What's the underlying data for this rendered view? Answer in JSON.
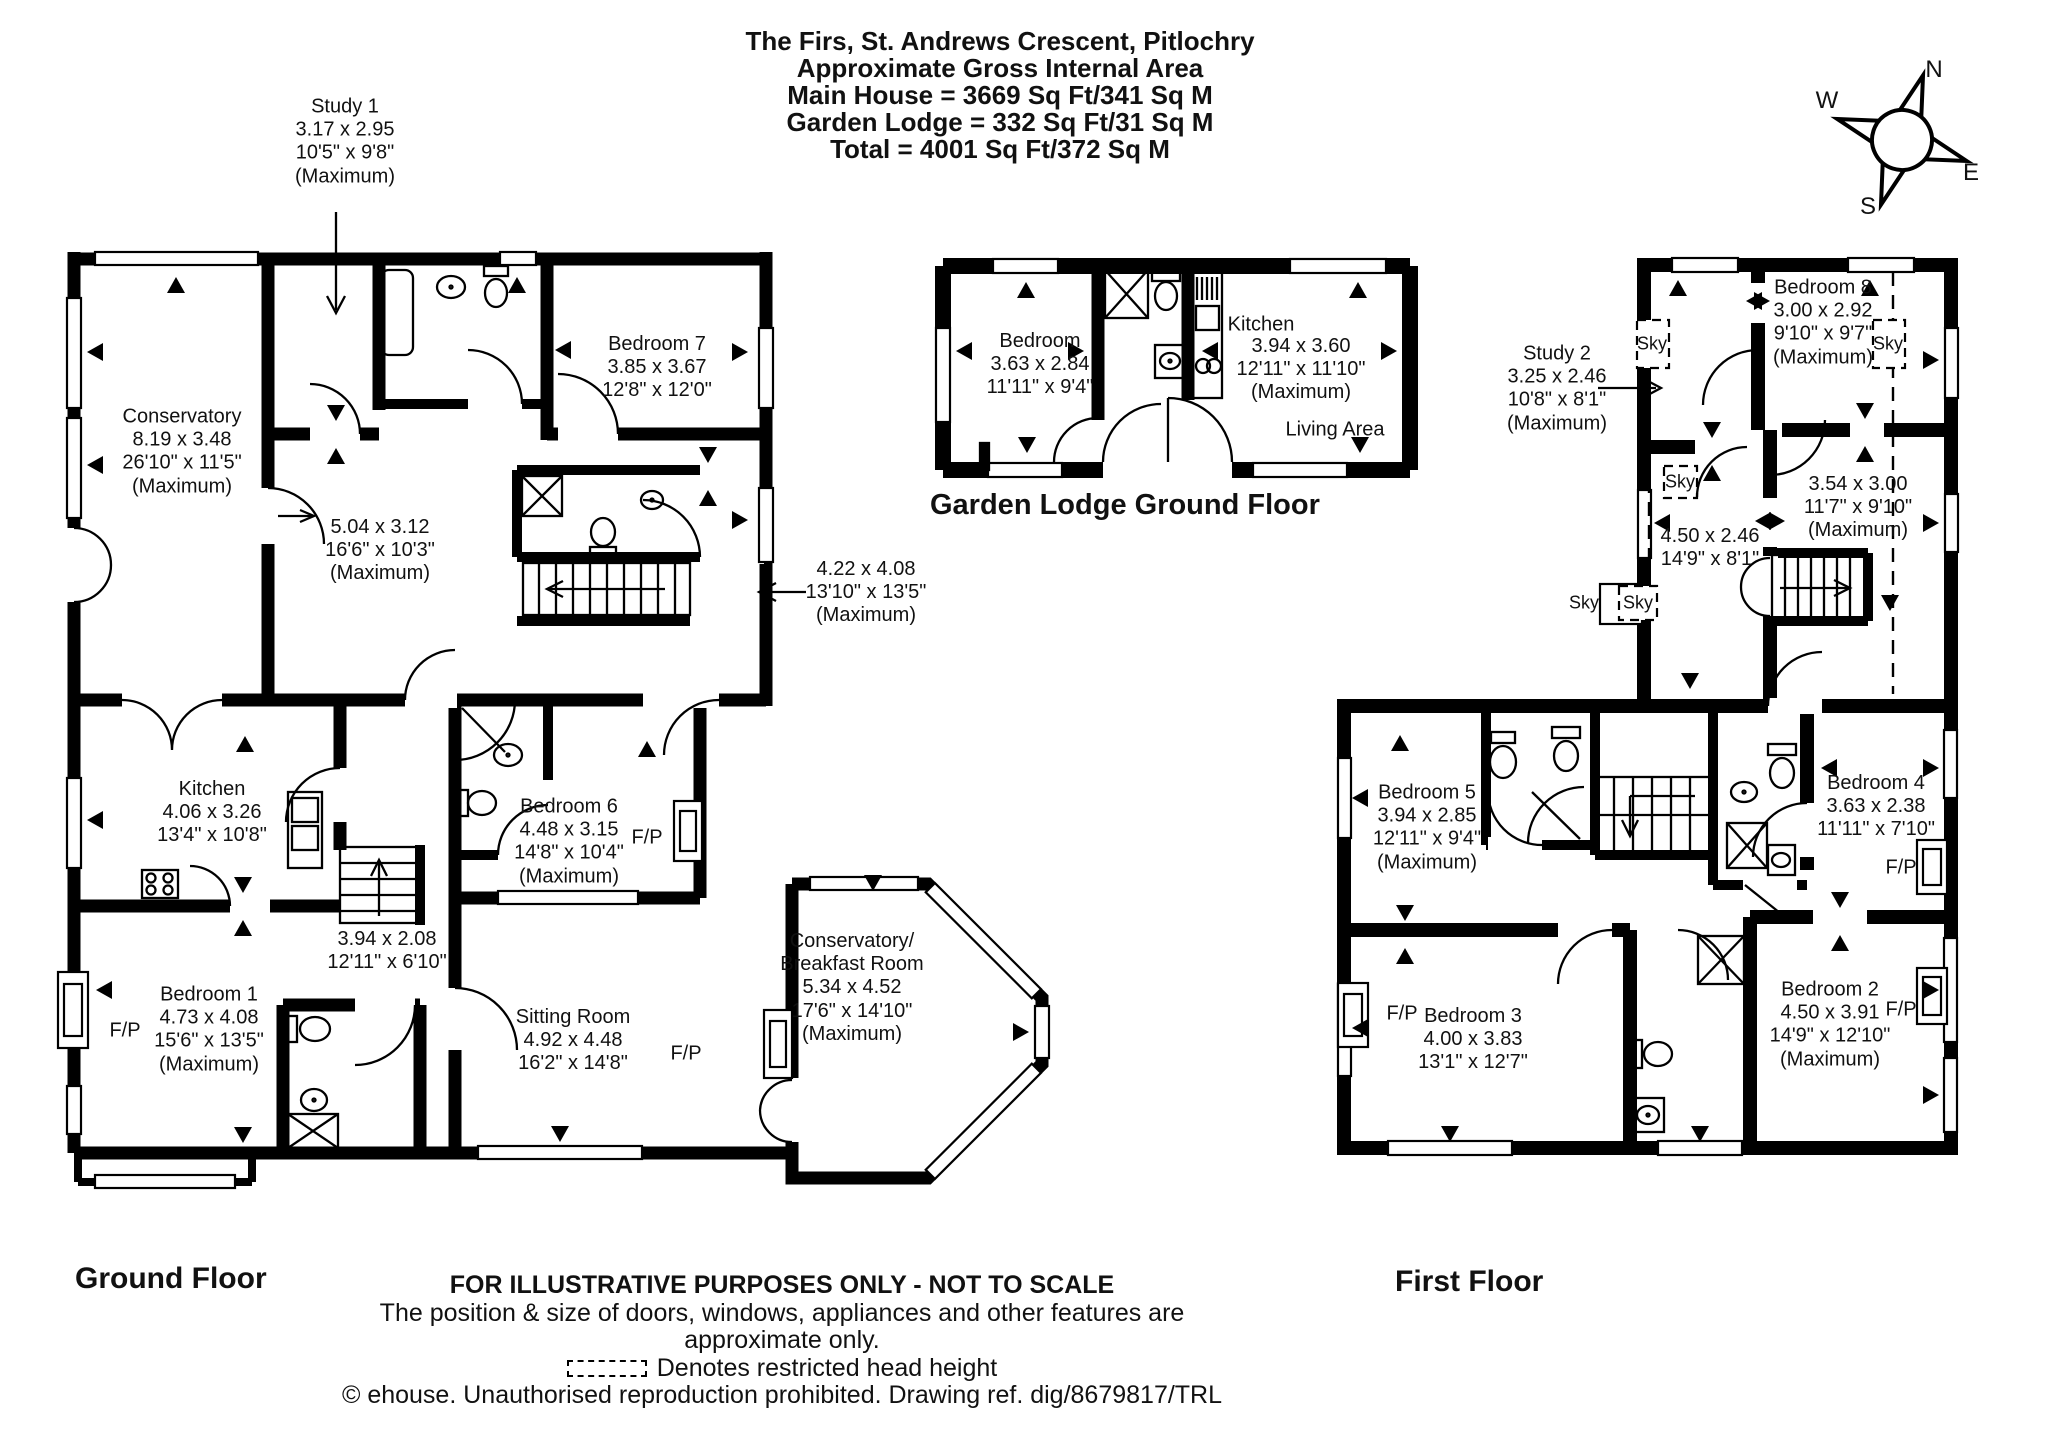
{
  "colors": {
    "line": "#000000",
    "background": "#ffffff"
  },
  "header": {
    "title": "The Firs, St. Andrews Crescent, Pitlochry",
    "subtitle": "Approximate Gross Internal Area",
    "area_main": "Main House = 3669 Sq Ft/341 Sq M",
    "area_lodge": "Garden Lodge = 332 Sq Ft/31 Sq M",
    "area_total": "Total = 4001 Sq Ft/372 Sq M"
  },
  "compass": {
    "n": "N",
    "e": "E",
    "s": "S",
    "w": "W"
  },
  "ground": {
    "floor_label": "Ground Floor",
    "fp": "F/P",
    "rooms": {
      "study1": {
        "name": "Study 1",
        "metric": "3.17 x 2.95",
        "imperial": "10'5\" x 9'8\"",
        "note": "(Maximum)"
      },
      "conservatory": {
        "name": "Conservatory",
        "metric": "8.19 x 3.48",
        "imperial": "26'10\" x 11'5\"",
        "note": "(Maximum)"
      },
      "bedroom7": {
        "name": "Bedroom 7",
        "metric": "3.85 x 3.67",
        "imperial": "12'8\" x 12'0\""
      },
      "room_504": {
        "metric": "5.04 x 3.12",
        "imperial": "16'6\" x 10'3\"",
        "note": "(Maximum)"
      },
      "room_422": {
        "metric": "4.22 x 4.08",
        "imperial": "13'10\" x 13'5\"",
        "note": "(Maximum)"
      },
      "kitchen": {
        "name": "Kitchen",
        "metric": "4.06 x 3.26",
        "imperial": "13'4\" x 10'8\""
      },
      "hall": {
        "metric": "3.94 x 2.08",
        "imperial": "12'11\" x 6'10\""
      },
      "bedroom1": {
        "name": "Bedroom 1",
        "metric": "4.73 x 4.08",
        "imperial": "15'6\" x 13'5\"",
        "note": "(Maximum)"
      },
      "bedroom6": {
        "name": "Bedroom 6",
        "metric": "4.48 x 3.15",
        "imperial": "14'8\" x 10'4\"",
        "note": "(Maximum)"
      },
      "sitting": {
        "name": "Sitting Room",
        "metric": "4.92 x 4.48",
        "imperial": "16'2\" x 14'8\""
      },
      "breakfast": {
        "name": "Conservatory/",
        "name2": "Breakfast Room",
        "metric": "5.34 x 4.52",
        "imperial": "17'6\" x 14'10\"",
        "note": "(Maximum)"
      }
    }
  },
  "lodge": {
    "floor_label": "Garden Lodge Ground Floor",
    "rooms": {
      "bedroom": {
        "name": "Bedroom",
        "metric": "3.63 x 2.84",
        "imperial": "11'11\" x 9'4\""
      },
      "kitchen": {
        "name": "Kitchen",
        "metric": "3.94 x 3.60",
        "imperial": "12'11\" x 11'10\"",
        "note": "(Maximum)"
      },
      "living": {
        "name": "Living Area"
      }
    }
  },
  "first": {
    "floor_label": "First Floor",
    "fp": "F/P",
    "sky": "Sky",
    "rooms": {
      "study2": {
        "name": "Study 2",
        "metric": "3.25 x 2.46",
        "imperial": "10'8\" x 8'1\"",
        "note": "(Maximum)"
      },
      "bedroom8": {
        "name": "Bedroom 8",
        "metric": "3.00 x 2.92",
        "imperial": "9'10\" x 9'7\"",
        "note": "(Maximum)"
      },
      "room_354": {
        "metric": "3.54 x 3.00",
        "imperial": "11'7\" x 9'10\"",
        "note": "(Maximum)"
      },
      "room_450": {
        "metric": "4.50 x 2.46",
        "imperial": "14'9\" x 8'1\""
      },
      "bedroom5": {
        "name": "Bedroom 5",
        "metric": "3.94 x 2.85",
        "imperial": "12'11\" x 9'4\"",
        "note": "(Maximum)"
      },
      "bedroom4": {
        "name": "Bedroom 4",
        "metric": "3.63 x 2.38",
        "imperial": "11'11\" x 7'10\""
      },
      "bedroom3": {
        "name": "Bedroom 3",
        "metric": "4.00 x 3.83",
        "imperial": "13'1\" x 12'7\""
      },
      "bedroom2": {
        "name": "Bedroom 2",
        "metric": "4.50 x 3.91",
        "imperial": "14'9\" x 12'10\"",
        "note": "(Maximum)"
      }
    }
  },
  "footer": {
    "line1": "FOR ILLUSTRATIVE PURPOSES ONLY - NOT TO SCALE",
    "line2": "The position & size of doors, windows, appliances and other features are approximate only.",
    "line3": "Denotes restricted head height",
    "line4": "© ehouse. Unauthorised reproduction prohibited. Drawing ref. dig/8679817/TRL"
  }
}
